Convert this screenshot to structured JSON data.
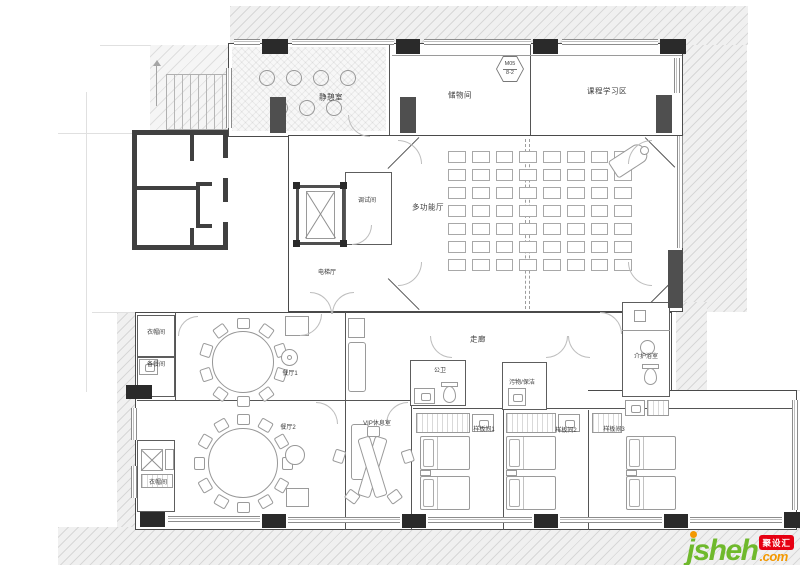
{
  "drawing": {
    "rooms": {
      "quiet_room": "静憩室",
      "storage": "储物间",
      "course_area": "课程学习区",
      "multi_hall": "多功能厅",
      "debug_room": "调试间",
      "elevator_hall": "电梯厅",
      "corridor": "走廊",
      "cloak_top": "衣帽间",
      "pantry": "备餐间",
      "dining1": "餐厅1",
      "dining2": "餐厅2",
      "cloak_bottom": "衣帽间",
      "vip": "VIP休息室",
      "public_wc": "公卫",
      "cleaning": "污物/保洁",
      "sample1": "样板间1",
      "sample2": "样板间2",
      "sample3": "样板间3",
      "care_bath": "介护浴室"
    },
    "door_tag": {
      "line1": "M05",
      "line2": "8-2"
    },
    "furniture": {
      "hall_seats": {
        "rows": 7,
        "cols": 8
      },
      "dining1_chairs": 10,
      "dining2_chairs": 12,
      "vip_chairs": 5,
      "quiet_stools": 7,
      "beds_per_sample_room": 2
    },
    "colors": {
      "wall": "#4a4a4a",
      "column": "#2a2a2a",
      "logo_green": "#6fb92c",
      "logo_orange": "#f39800",
      "badge_red": "#e60012"
    }
  },
  "logo": {
    "name": "jsheh",
    "tld": ".com",
    "badge": "聚设汇"
  }
}
